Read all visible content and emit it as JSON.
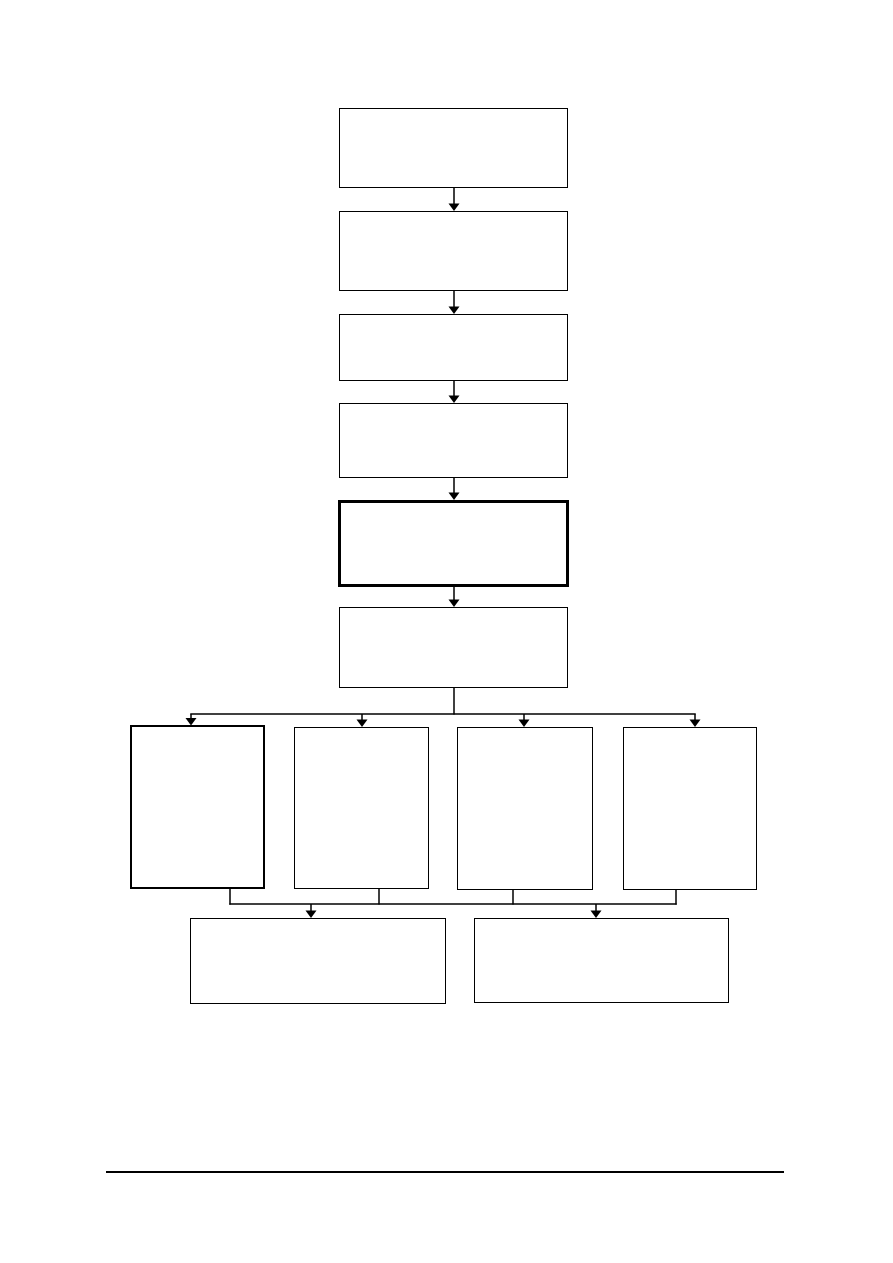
{
  "colors": {
    "page_background": "#ffffff",
    "line_color": "#000000",
    "box_fill": "#ffffff"
  },
  "flowchart": {
    "nodes": [
      {
        "id": "step-1",
        "label": "",
        "border": "normal"
      },
      {
        "id": "step-2",
        "label": "",
        "border": "normal"
      },
      {
        "id": "step-3",
        "label": "",
        "border": "normal"
      },
      {
        "id": "step-4",
        "label": "",
        "border": "normal"
      },
      {
        "id": "step-5",
        "label": "",
        "border": "thick"
      },
      {
        "id": "step-6",
        "label": "",
        "border": "normal"
      },
      {
        "id": "branch-1",
        "label": "",
        "border": "thick"
      },
      {
        "id": "branch-2",
        "label": "",
        "border": "normal"
      },
      {
        "id": "branch-3",
        "label": "",
        "border": "normal"
      },
      {
        "id": "branch-4",
        "label": "",
        "border": "normal"
      },
      {
        "id": "merge-1",
        "label": "",
        "border": "normal"
      },
      {
        "id": "merge-2",
        "label": "",
        "border": "normal"
      }
    ],
    "edges": [
      {
        "from": "step-1",
        "to": "step-2"
      },
      {
        "from": "step-2",
        "to": "step-3"
      },
      {
        "from": "step-3",
        "to": "step-4"
      },
      {
        "from": "step-4",
        "to": "step-5"
      },
      {
        "from": "step-5",
        "to": "step-6"
      },
      {
        "from": "step-6",
        "to": "branch-1"
      },
      {
        "from": "step-6",
        "to": "branch-2"
      },
      {
        "from": "step-6",
        "to": "branch-3"
      },
      {
        "from": "step-6",
        "to": "branch-4"
      },
      {
        "from": "branch-1",
        "to": "merge-1"
      },
      {
        "from": "branch-2",
        "to": "merge-1"
      },
      {
        "from": "branch-3",
        "to": "merge-2"
      },
      {
        "from": "branch-4",
        "to": "merge-2"
      }
    ]
  }
}
